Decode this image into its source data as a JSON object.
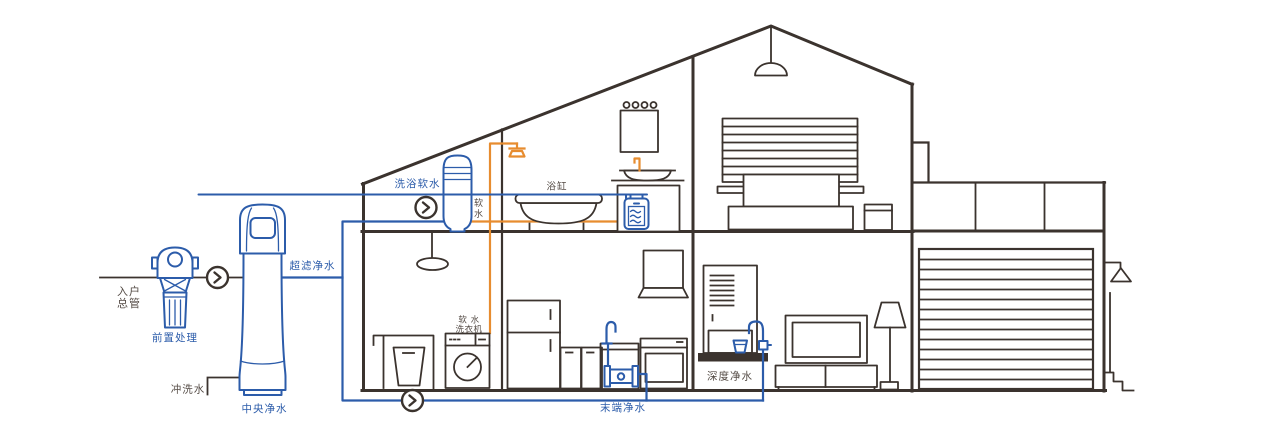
{
  "diagram": {
    "description_type": "home-water-purification-cutaway",
    "labels": {
      "inlet": [
        "入户",
        "总管"
      ],
      "pre_treatment": "前置处理",
      "central_purifier": "中央净水",
      "flush_water": "冲洗水",
      "ultrafiltration": "超滤净水",
      "bath_softener": "洗浴软水",
      "soft_water_vertical": [
        "软",
        "水"
      ],
      "bathtub": "浴缸",
      "soft_water_washer": [
        "软 水",
        "洗衣机"
      ],
      "terminal_purifier": "末端净水",
      "deep_purifier": "深度净水"
    },
    "icons": {
      "flow_direction_badge": "chevron-right-in-circle"
    },
    "colors": {
      "pipe_blue": "#2c5caa",
      "pipe_orange": "#e78c2f",
      "line_dark": "#3b332e",
      "text_dark": "#544b45",
      "background": "#ffffff"
    }
  }
}
